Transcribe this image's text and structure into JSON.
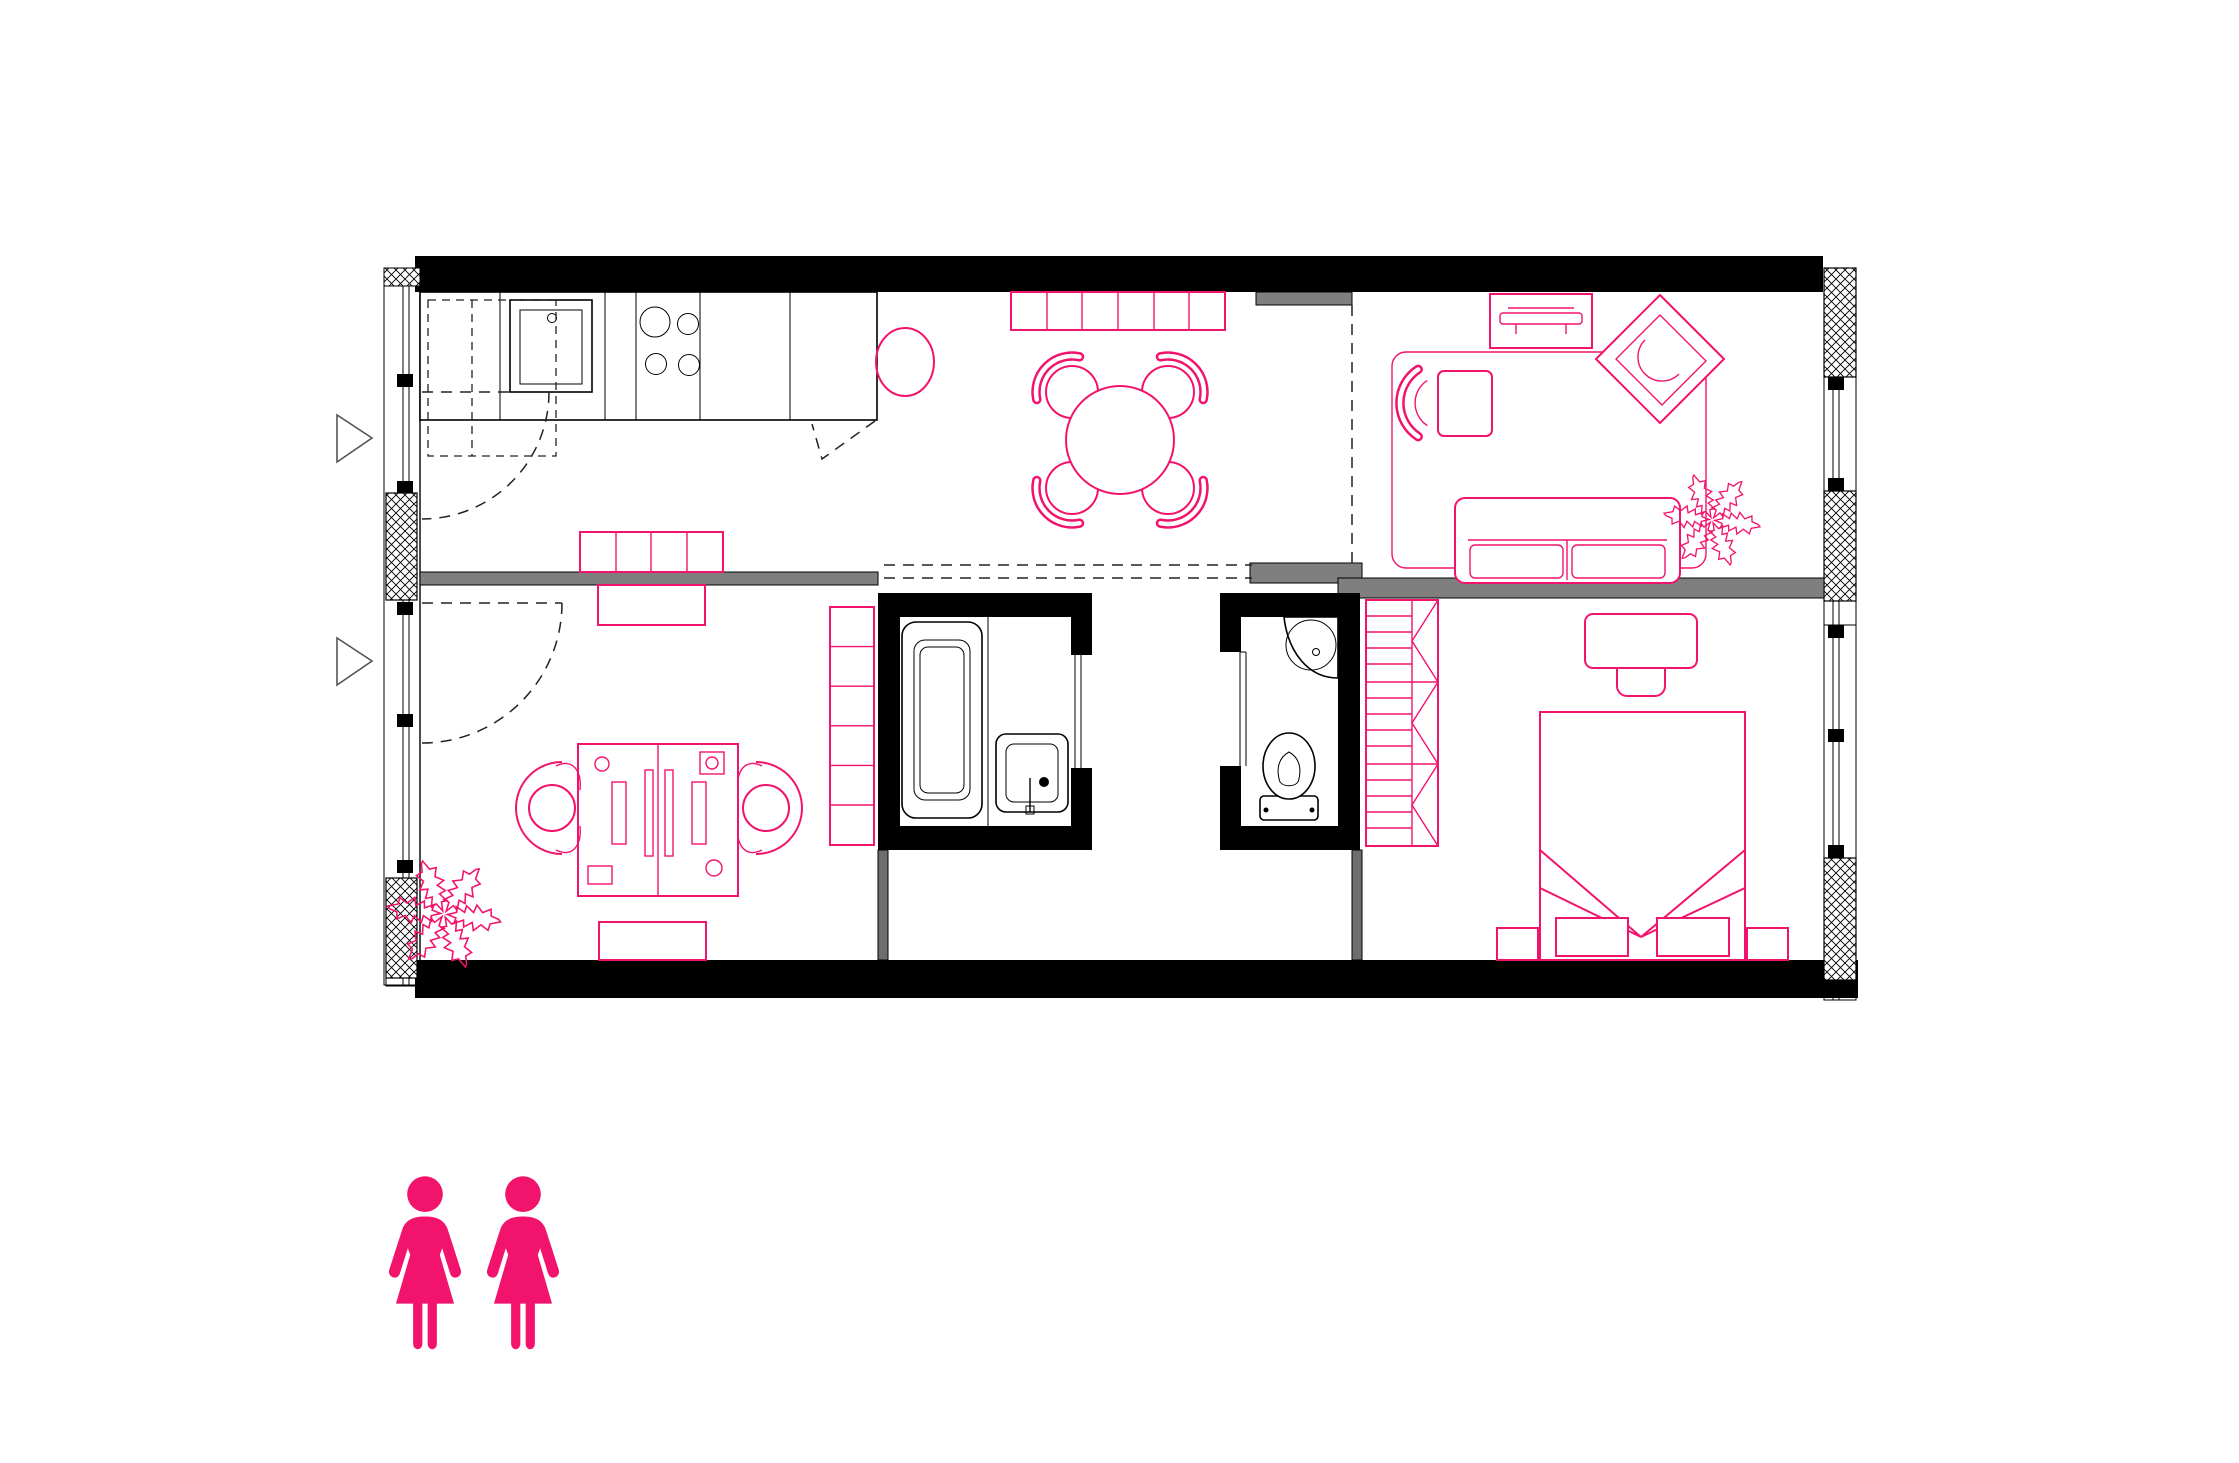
{
  "document": {
    "kind": "architectural-floor-plan",
    "title": "",
    "visible_text": [],
    "occupants_legend": {
      "icon": "woman-icon",
      "count": 2,
      "color": "#f2136c"
    }
  },
  "colors": {
    "background": "#ffffff",
    "structural_walls": "#000000",
    "partition_walls": "#7f7f7f",
    "furniture_accent": "#f2136c",
    "drawing_lines": "#000000"
  },
  "plan": {
    "rooms": [
      {
        "name": "kitchen",
        "furniture": [
          "kitchen-counter",
          "sink",
          "cooktop-4-burners",
          "overhead-cabinet-dashed",
          "entry-door-swing",
          "round-side-table",
          "sideboard-4-cells"
        ]
      },
      {
        "name": "dining-area",
        "furniture": [
          "sideboard-6-cells",
          "round-dining-table",
          "dining-chair",
          "dining-chair",
          "dining-chair",
          "dining-chair"
        ]
      },
      {
        "name": "living-room",
        "furniture": [
          "rug",
          "armchair",
          "tv-console",
          "lounge-chair-diamond",
          "two-seat-sofa",
          "potted-plant"
        ]
      },
      {
        "name": "office",
        "furniture": [
          "door-swing",
          "cabinet-top",
          "double-desk",
          "monitor",
          "monitor",
          "office-worker",
          "office-worker",
          "shelf-column-6-cells",
          "potted-plant",
          "cabinet-bottom"
        ]
      },
      {
        "name": "bathroom",
        "furniture": [
          "bathtub",
          "washbasin",
          "sliding-door"
        ]
      },
      {
        "name": "wc",
        "furniture": [
          "corner-washbasin",
          "toilet",
          "sliding-door"
        ]
      },
      {
        "name": "hallway",
        "furniture": []
      },
      {
        "name": "storage-room",
        "furniture": []
      },
      {
        "name": "bedroom",
        "furniture": [
          "wardrobe-3-cells",
          "desk",
          "chair",
          "double-bed",
          "pillow",
          "pillow",
          "nightstand",
          "nightstand"
        ]
      }
    ],
    "structure": [
      "top-exterior-wall",
      "bottom-exterior-wall",
      "left-window-wall",
      "right-window-wall",
      "insulated-pier-hatched",
      "entry-arrow",
      "entry-arrow",
      "dashed-partition-line",
      "gray-partition-kitchen-office",
      "gray-partition-living-bedroom",
      "bathroom-core-black-walls"
    ]
  }
}
